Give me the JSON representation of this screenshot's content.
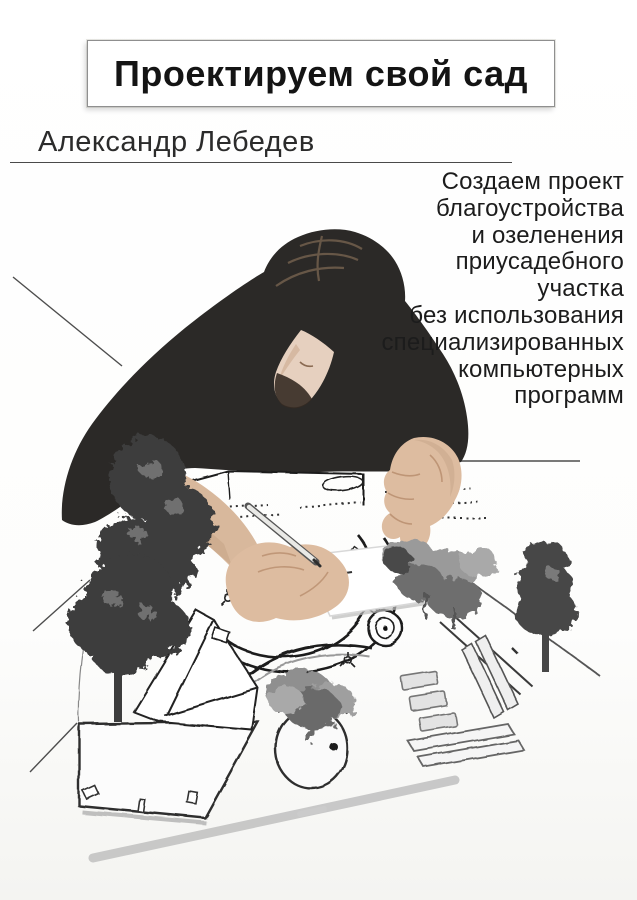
{
  "cover": {
    "title": "Проектируем свой сад",
    "author": "Александр Лебедев",
    "subtitle_lines": [
      "Создаем проект",
      "благоустройства",
      "и озеленения",
      "приусадебного",
      "участка",
      "без использования",
      "специализированных",
      "компьютерных",
      "программ"
    ],
    "illustration": {
      "scene": "man-in-dark-sweater-hand-drawing-garden-landscape-plan",
      "elements": [
        "garden-plan-sketch",
        "tree-silhouettes",
        "perspective-lines",
        "pen",
        "paper-sheet"
      ]
    },
    "colors": {
      "title_text": "#141414",
      "body_text": "#1c1c1c",
      "rule": "#4a4a4a",
      "sweater": "#2b2927",
      "skin": "#d9b89c",
      "tree_dark": "#3d3d3d",
      "tree_light": "#9a9a9a",
      "sketch_line": "#1c1c1c",
      "shadow_stripe": "#b8b8b8"
    }
  }
}
